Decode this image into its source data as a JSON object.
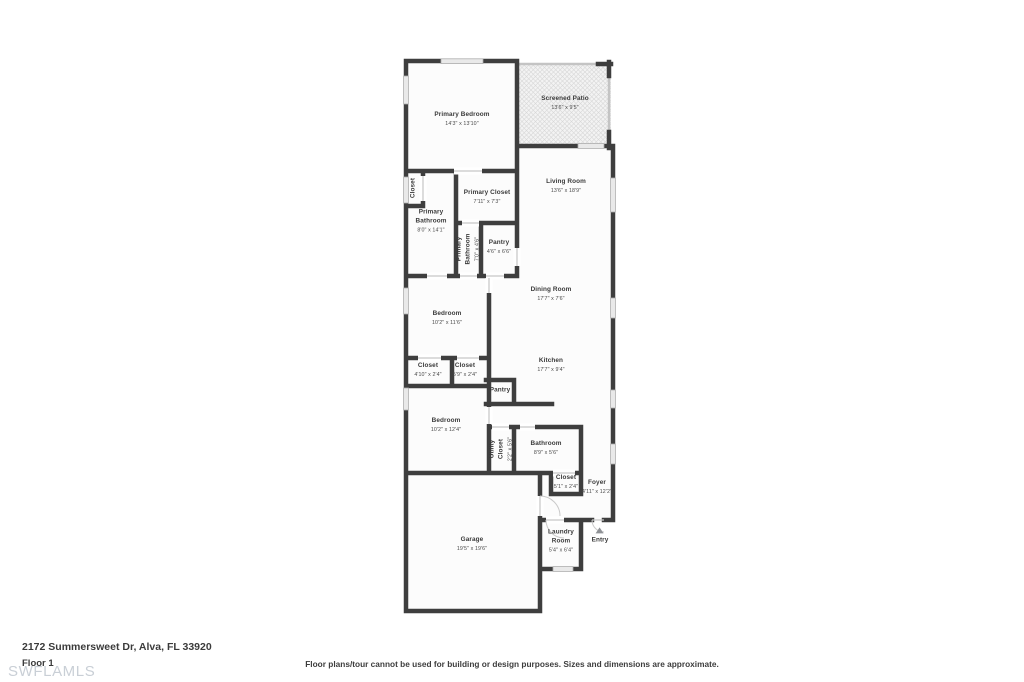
{
  "footer": {
    "address": "2172 Summersweet Dr, Alva, FL 33920",
    "floor_label": "Floor 1",
    "watermark": "SWFLAMLS",
    "disclaimer": "Floor plans/tour cannot be used for building or design purposes. Sizes and dimensions are approximate."
  },
  "colors": {
    "wall": "#3e3e3e",
    "screen_wall": "#c4c4c4",
    "window_fill": "#e9e9e9",
    "window_border": "#adadad",
    "door_header": "#c6c6c6",
    "room_fill": "#fcfcfc",
    "patio_fill": "#f3f3f3",
    "label_text": "#3a3a3a",
    "watermark_text": "#c9cfd6",
    "entry_arrow": "#8f9296"
  },
  "rooms": [
    {
      "name": "Primary Bedroom",
      "dims": "14'3\" x 13'10\"",
      "x": 462,
      "y": 119,
      "rotate": 0
    },
    {
      "name": "Screened Patio",
      "dims": "13'6\" x 9'5\"",
      "x": 565,
      "y": 103,
      "rotate": 0
    },
    {
      "name": "Living Room",
      "dims": "13'6\" x 18'9\"",
      "x": 566,
      "y": 186,
      "rotate": 0
    },
    {
      "name": "Closet",
      "dims": "",
      "x": 414,
      "y": 188,
      "rotate": -90
    },
    {
      "name": "Primary Closet",
      "dims": "7'11\" x 7'3\"",
      "x": 487,
      "y": 197,
      "rotate": 0
    },
    {
      "name": "Primary\nBathroom",
      "dims": "8'0\" x 14'1\"",
      "x": 431,
      "y": 221,
      "rotate": 0
    },
    {
      "name": "Primary\nBathroom",
      "dims": "7'0\" x 4'6\"",
      "x": 468,
      "y": 249,
      "rotate": -90
    },
    {
      "name": "Pantry",
      "dims": "4'6\" x 6'6\"",
      "x": 499,
      "y": 247,
      "rotate": 0
    },
    {
      "name": "Dining Room",
      "dims": "17'7\" x 7'6\"",
      "x": 551,
      "y": 294,
      "rotate": 0
    },
    {
      "name": "Bedroom",
      "dims": "10'2\" x 11'6\"",
      "x": 447,
      "y": 318,
      "rotate": 0
    },
    {
      "name": "Kitchen",
      "dims": "17'7\" x 9'4\"",
      "x": 551,
      "y": 365,
      "rotate": 0
    },
    {
      "name": "Closet",
      "dims": "4'10\" x 2'4\"",
      "x": 428,
      "y": 370,
      "rotate": 0
    },
    {
      "name": "Closet",
      "dims": "5'9\" x 2'4\"",
      "x": 465,
      "y": 370,
      "rotate": 0
    },
    {
      "name": "Pantry",
      "dims": "",
      "x": 500,
      "y": 391,
      "rotate": 0
    },
    {
      "name": "Bedroom",
      "dims": "10'2\" x 12'4\"",
      "x": 446,
      "y": 425,
      "rotate": 0
    },
    {
      "name": "Utility\nCloset",
      "dims": "2'2\" x 5'6\"",
      "x": 501,
      "y": 449,
      "rotate": -90
    },
    {
      "name": "Bathroom",
      "dims": "8'9\" x 5'6\"",
      "x": 546,
      "y": 448,
      "rotate": 0
    },
    {
      "name": "Closet",
      "dims": "5'1\" x 2'4\"",
      "x": 566,
      "y": 482,
      "rotate": 0
    },
    {
      "name": "Foyer",
      "dims": "4'11\" x 12'2\"",
      "x": 597,
      "y": 487,
      "rotate": 0
    },
    {
      "name": "Garage",
      "dims": "19'5\" x 19'6\"",
      "x": 472,
      "y": 544,
      "rotate": 0
    },
    {
      "name": "Laundry\nRoom",
      "dims": "5'4\" x 6'4\"",
      "x": 561,
      "y": 541,
      "rotate": 0
    },
    {
      "name": "Entry",
      "dims": "",
      "x": 600,
      "y": 536,
      "rotate": 0,
      "icon": "triangle-up"
    }
  ]
}
